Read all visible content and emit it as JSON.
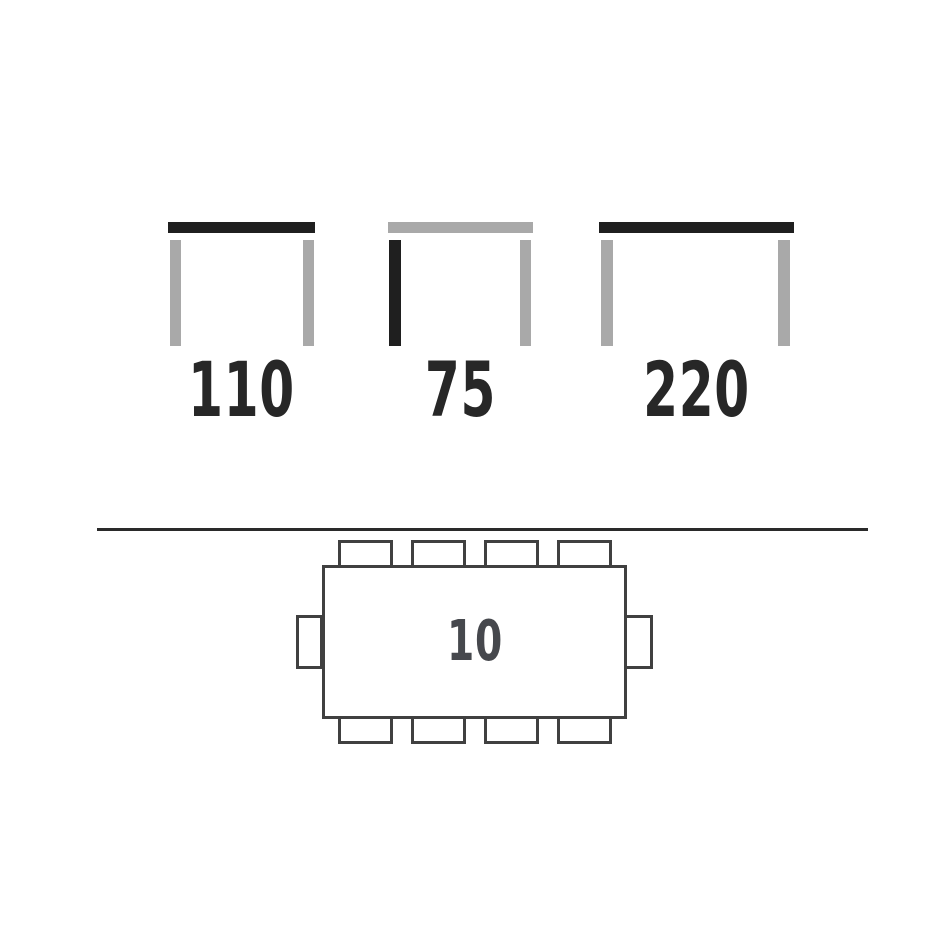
{
  "colors": {
    "tabletop_dark": "#1f1f1f",
    "tabletop_gray": "#a9a9a9",
    "outline": "#404040",
    "divider": "#2a2a2a",
    "dimension_text": "#272727",
    "seat_count_text": "#46484d",
    "background": "#ffffff"
  },
  "side_view_dimensions": {
    "icons": [
      {
        "label": "110",
        "tabletop_color": "#1f1f1f",
        "left_leg_color": "#a9a9a9",
        "right_leg_color": "#a9a9a9"
      },
      {
        "label": "75",
        "tabletop_color": "#a9a9a9",
        "left_leg_color": "#1f1f1f",
        "right_leg_color": "#a9a9a9"
      },
      {
        "label": "220",
        "tabletop_color": "#1f1f1f",
        "left_leg_color": "#a9a9a9",
        "right_leg_color": "#a9a9a9"
      }
    ]
  },
  "top_view_seating": {
    "seat_count": "10",
    "chairs_top": 4,
    "chairs_bottom": 4,
    "chairs_left": 1,
    "chairs_right": 1
  }
}
